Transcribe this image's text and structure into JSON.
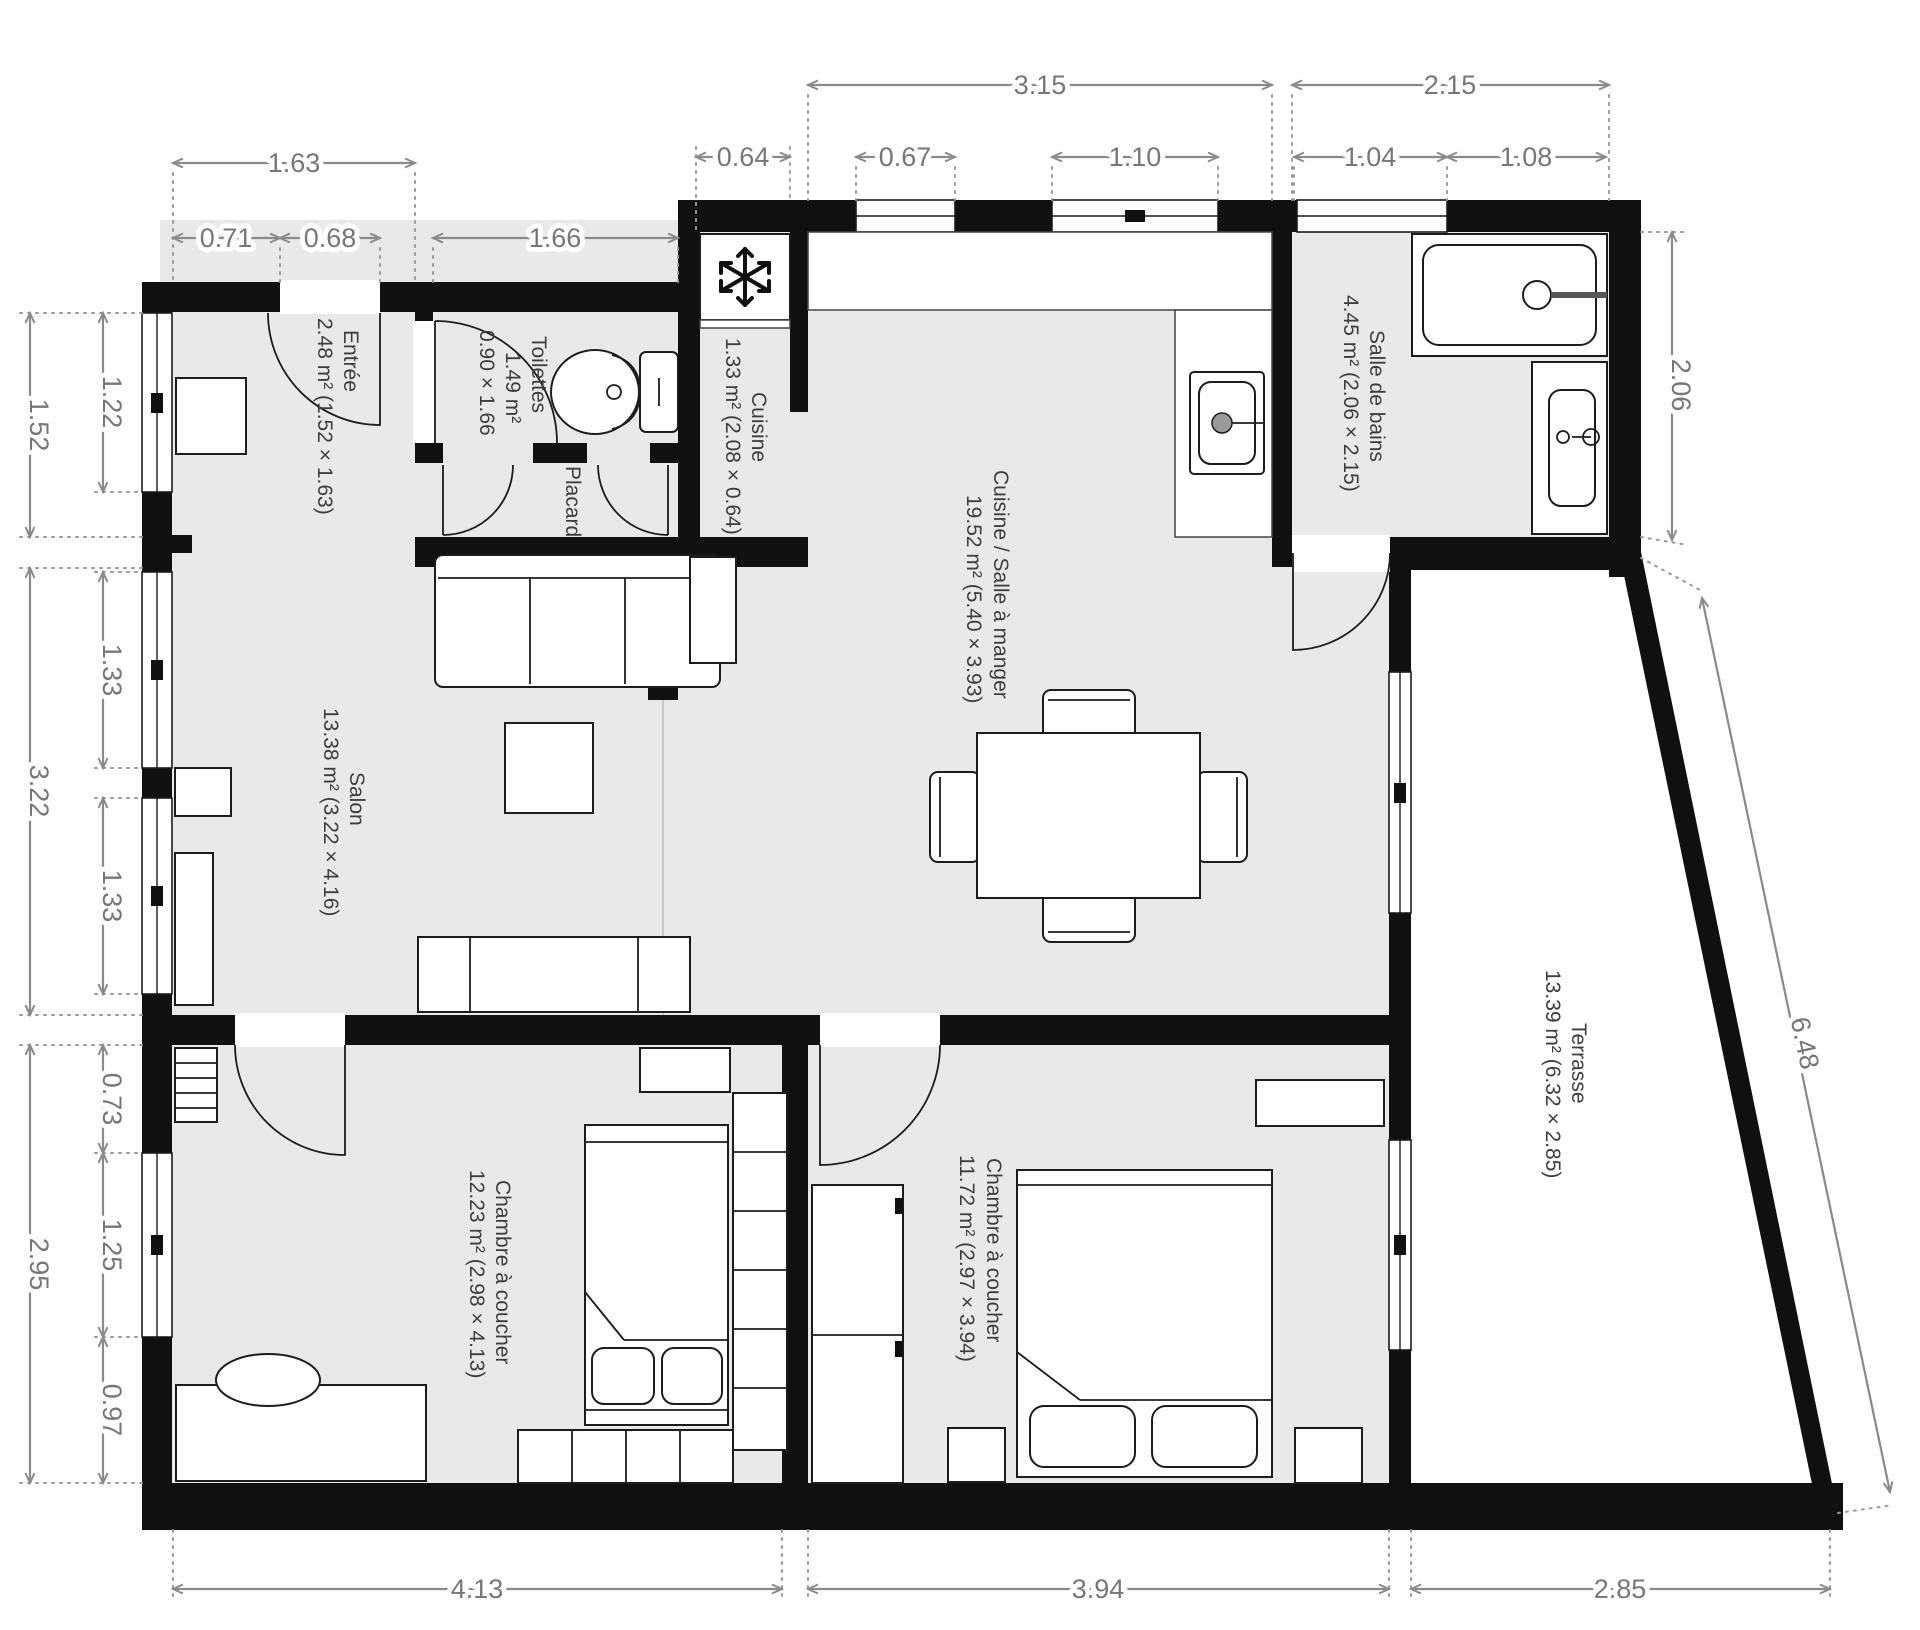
{
  "title": "Plan d'appartement",
  "rooms": {
    "entree": {
      "name": "Entrée",
      "size": "2.48 m² (1.52 × 1.63)"
    },
    "toilettes": {
      "name": "Toilettes",
      "area": "1.49 m²",
      "size": "0.90 × 1.66"
    },
    "placard": {
      "name": "Placard"
    },
    "cuisine": {
      "name": "Cuisine",
      "size": "1.33 m² (2.08 × 0.64)"
    },
    "dining": {
      "name": "Cuisine / Salle à manger",
      "size": "19.52 m² (5.40 × 3.93)"
    },
    "bathroom": {
      "name": "Salle de bains",
      "size": "4.45 m² (2.06 × 2.15)"
    },
    "salon": {
      "name": "Salon",
      "size": "13.38 m² (3.22 × 4.16)"
    },
    "terrace": {
      "name": "Terrasse",
      "size": "13.39 m² (6.32 × 2.85)"
    },
    "bedroom1": {
      "name": "Chambre à coucher",
      "size": "12.23 m² (2.98 × 4.13)"
    },
    "bedroom2": {
      "name": "Chambre à coucher",
      "size": "11.72 m² (2.97 × 3.94)"
    }
  },
  "dims": {
    "top": [
      "3.15",
      "2.15"
    ],
    "top2": [
      "0.64",
      "0.67",
      "1.10",
      "1.04",
      "1.08"
    ],
    "topleft": [
      "1.63",
      "0.71",
      "0.68",
      "1.66"
    ],
    "left": [
      "1.52",
      "3.22",
      "2.95"
    ],
    "left2": [
      "1.22",
      "1.33",
      "1.33",
      "0.73",
      "1.25",
      "0.97"
    ],
    "right": [
      "2.06",
      "6.48"
    ],
    "bottom": [
      "4.13",
      "3.94",
      "2.85"
    ]
  },
  "colors": {
    "wall": "#101010",
    "floor": "#e9e9e9",
    "dimension": "#8a8a8a",
    "label": "#3d3d3d"
  }
}
